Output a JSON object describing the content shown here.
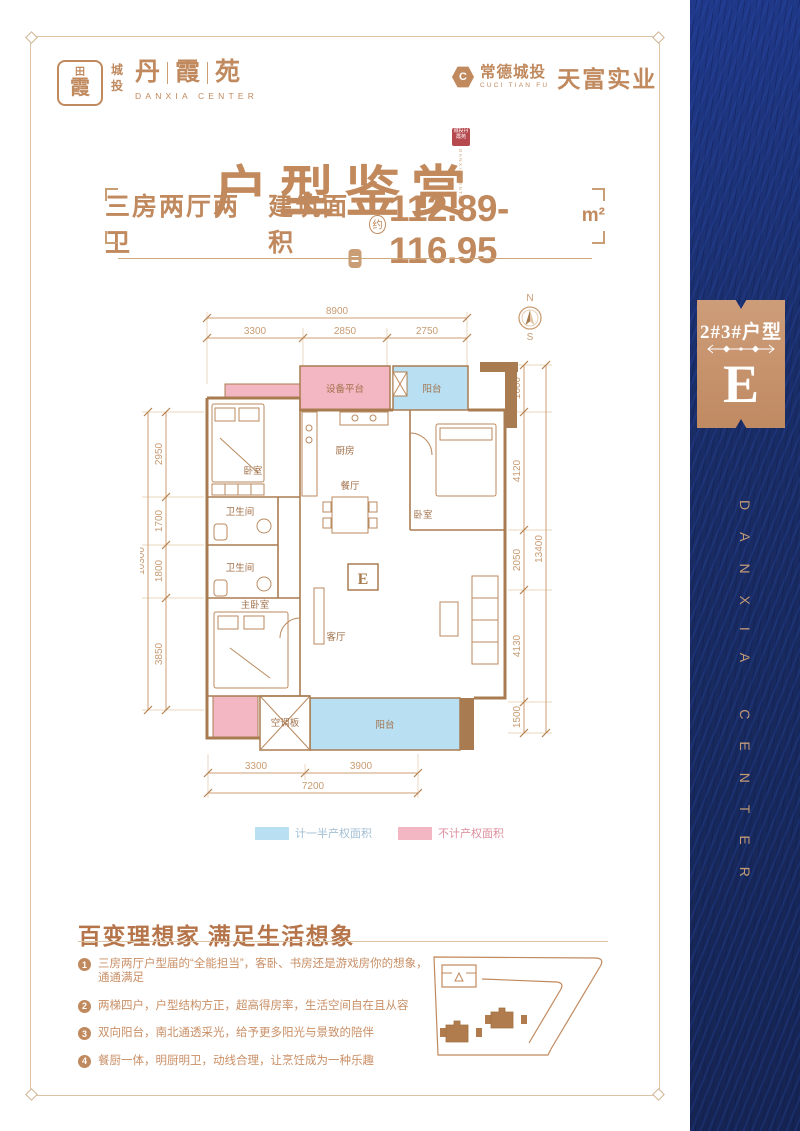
{
  "colors": {
    "accent": "#c0895e",
    "navy": "#1a2d66",
    "pink": "#f3b7c3",
    "blue": "#b9dff2",
    "wall": "#a87c50"
  },
  "header": {
    "seal_top": "田",
    "seal_char": "霞",
    "brand_small": "城投",
    "brand_chars": [
      "丹",
      "霞",
      "苑"
    ],
    "brand_sub": "DANXIA CENTER",
    "dev_icon_letter": "C",
    "dev_name": "常德城投",
    "dev_sub": "CUCI TIAN FU",
    "dev_name2": "天富实业"
  },
  "title": {
    "text": "户型鉴赏",
    "seal_text": "城投丹霞苑",
    "seal_sub": "DANXIA CENTER"
  },
  "spec": {
    "rooms": "三房两厅两卫",
    "area_label": "建筑面积",
    "approx": "约",
    "value": "112.89-116.95",
    "unit": "m²"
  },
  "floorplan": {
    "compass_n": "N",
    "compass_s": "S",
    "dims_top_overall": "8900",
    "dims_top": [
      "3300",
      "2850",
      "2750"
    ],
    "dims_left_overall": "10300",
    "dims_left": [
      "2950",
      "1700",
      "1800",
      "3850"
    ],
    "dims_right_overall": "13400",
    "dims_right": [
      "1600",
      "4120",
      "2050",
      "4130",
      "1500"
    ],
    "dims_bottom": [
      "3300",
      "3900"
    ],
    "dims_bottom_overall": "7200",
    "rooms": {
      "equipment": "设备平台",
      "balcony_top": "阳台",
      "bedroom_tl": "卧室",
      "kitchen": "厨房",
      "dining": "餐厅",
      "bedroom_r": "卧室",
      "bath1": "卫生间",
      "bath2": "卫生间",
      "master": "主卧室",
      "living": "客厅",
      "balcony_bottom": "阳台",
      "ac": "空调板",
      "unit": "E"
    },
    "legend": [
      {
        "label": "计一半产权面积"
      },
      {
        "label": "不计产权面积"
      }
    ]
  },
  "features": {
    "heading": "百变理想家  满足生活想象",
    "items": [
      {
        "num": "1",
        "text": "三房两厅户型届的“全能担当”，客卧、书房还是游戏房你的想象，通通满足"
      },
      {
        "num": "2",
        "text": "两梯四户，户型结构方正，超高得房率，生活空间自在且从容"
      },
      {
        "num": "3",
        "text": "双向阳台，南北通透采光，给予更多阳光与景致的陪伴"
      },
      {
        "num": "4",
        "text": "餐厨一体，明厨明卫，动线合理，让烹饪成为一种乐趣"
      }
    ]
  },
  "sidebar": {
    "badge_title": "2#3#户型",
    "badge_letter": "E",
    "vertical_text": "DANXIA CENTER"
  }
}
